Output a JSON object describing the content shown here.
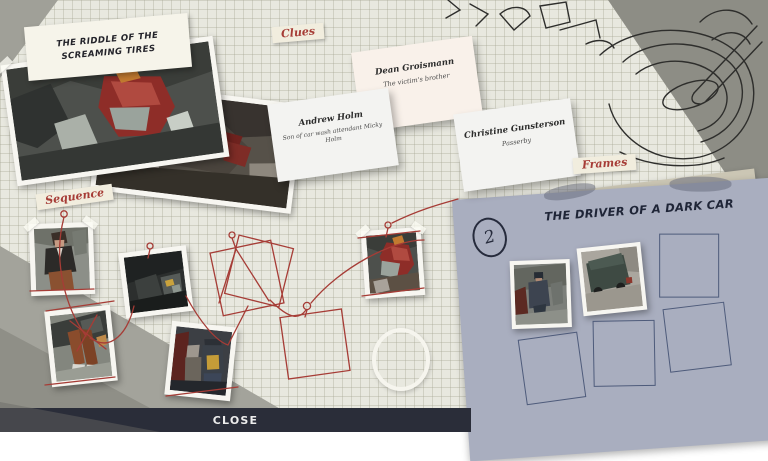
{
  "case": {
    "title": "THE RIDDLE OF THE SCREAMING TIRES"
  },
  "section_labels": {
    "clues": "Clues",
    "sequence": "Sequence",
    "frames": "Frames"
  },
  "clue_cards": [
    {
      "name": "Dean Groismann",
      "description": "The victim's brother"
    },
    {
      "name": "Andrew Holm",
      "description": "Son of car wash attendant Micky Holm"
    },
    {
      "name": "Christine Gunsterson",
      "description": "Passerby"
    }
  ],
  "frames_panel": {
    "number": "2",
    "title": "THE DRIVER OF A DARK CAR",
    "filled_slots": 2,
    "empty_slots": 4
  },
  "sequence": {
    "photo_count": 5,
    "empty_square_slots": 3,
    "empty_circle_slots": 1
  },
  "footer": {
    "close": "CLOSE"
  },
  "colors": {
    "accent_red": "#a63c36",
    "panel_blue": "#a9aebf",
    "bar_dark": "#2a2d39",
    "paper": "#e8e8df"
  }
}
